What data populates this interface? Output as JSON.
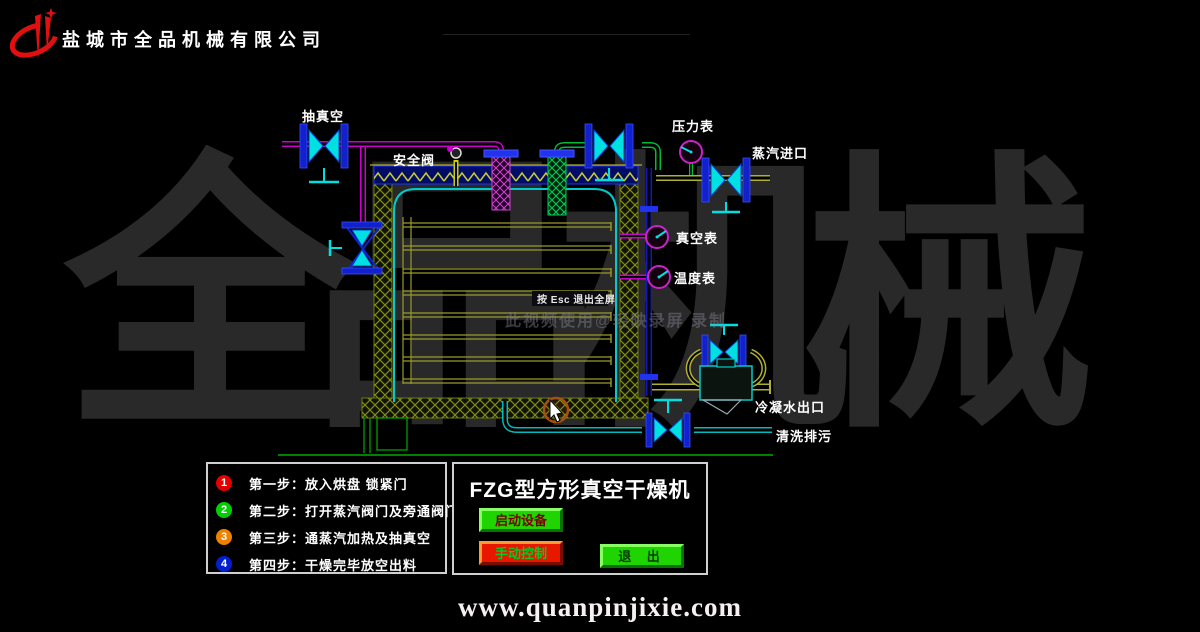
{
  "header": {
    "company_name": "盐城市全品机械有限公司",
    "logo_icon": "quanpin-brand-logo",
    "logo_color": "#e01010"
  },
  "watermark": {
    "brand_text": "全品机械",
    "recording_note": "此视频使用@轻映录屏 录制",
    "fullscreen_hint": "按 Esc 退出全屏"
  },
  "diagram": {
    "labels": {
      "vacuum_line": "抽真空",
      "safety_valve": "安全阀",
      "pressure_gauge": "压力表",
      "steam_inlet": "蒸汽进口",
      "vacuum_gauge": "真空表",
      "temperature_gauge": "温度表",
      "condensate_outlet": "冷凝水出口",
      "flush_drain": "清洗排污"
    },
    "colors": {
      "pipe_magenta": "#cc00cc",
      "pipe_green": "#00bb33",
      "pipe_olive": "#b0b030",
      "pipe_cyan": "#00bbbb",
      "pipe_navy": "#1515bb",
      "flange_blue": "#2233ee",
      "valve_cyan": "#00e0e0",
      "gauge_ring_magenta": "#cc22cc",
      "insulation_hatch": "#7f8f10",
      "vessel_outline": "#00cccc",
      "ground_green": "#00aa00"
    }
  },
  "steps_panel": {
    "items": [
      {
        "num": "1",
        "color": "#e00000",
        "label": "第一步：放入烘盘  锁紧门"
      },
      {
        "num": "2",
        "color": "#00d000",
        "label": "第二步：打开蒸汽阀门及旁通阀门\\排污"
      },
      {
        "num": "3",
        "color": "#f08000",
        "label": "第三步：通蒸汽加热及抽真空"
      },
      {
        "num": "4",
        "color": "#0020d0",
        "label": "第四步：干燥完毕放空出料"
      }
    ]
  },
  "control_panel": {
    "title": "FZG型方形真空干燥机",
    "buttons": [
      {
        "label": "启动设备",
        "face": "#1fd400",
        "text_color": "#7a0000"
      },
      {
        "label": "手动控制",
        "face": "#e81800",
        "text_color": "#00cc22"
      },
      {
        "label": "退 出",
        "face": "#1fd400",
        "text_color": "#073a07"
      }
    ]
  },
  "footer": {
    "website": "www.quanpinjixie.com"
  }
}
